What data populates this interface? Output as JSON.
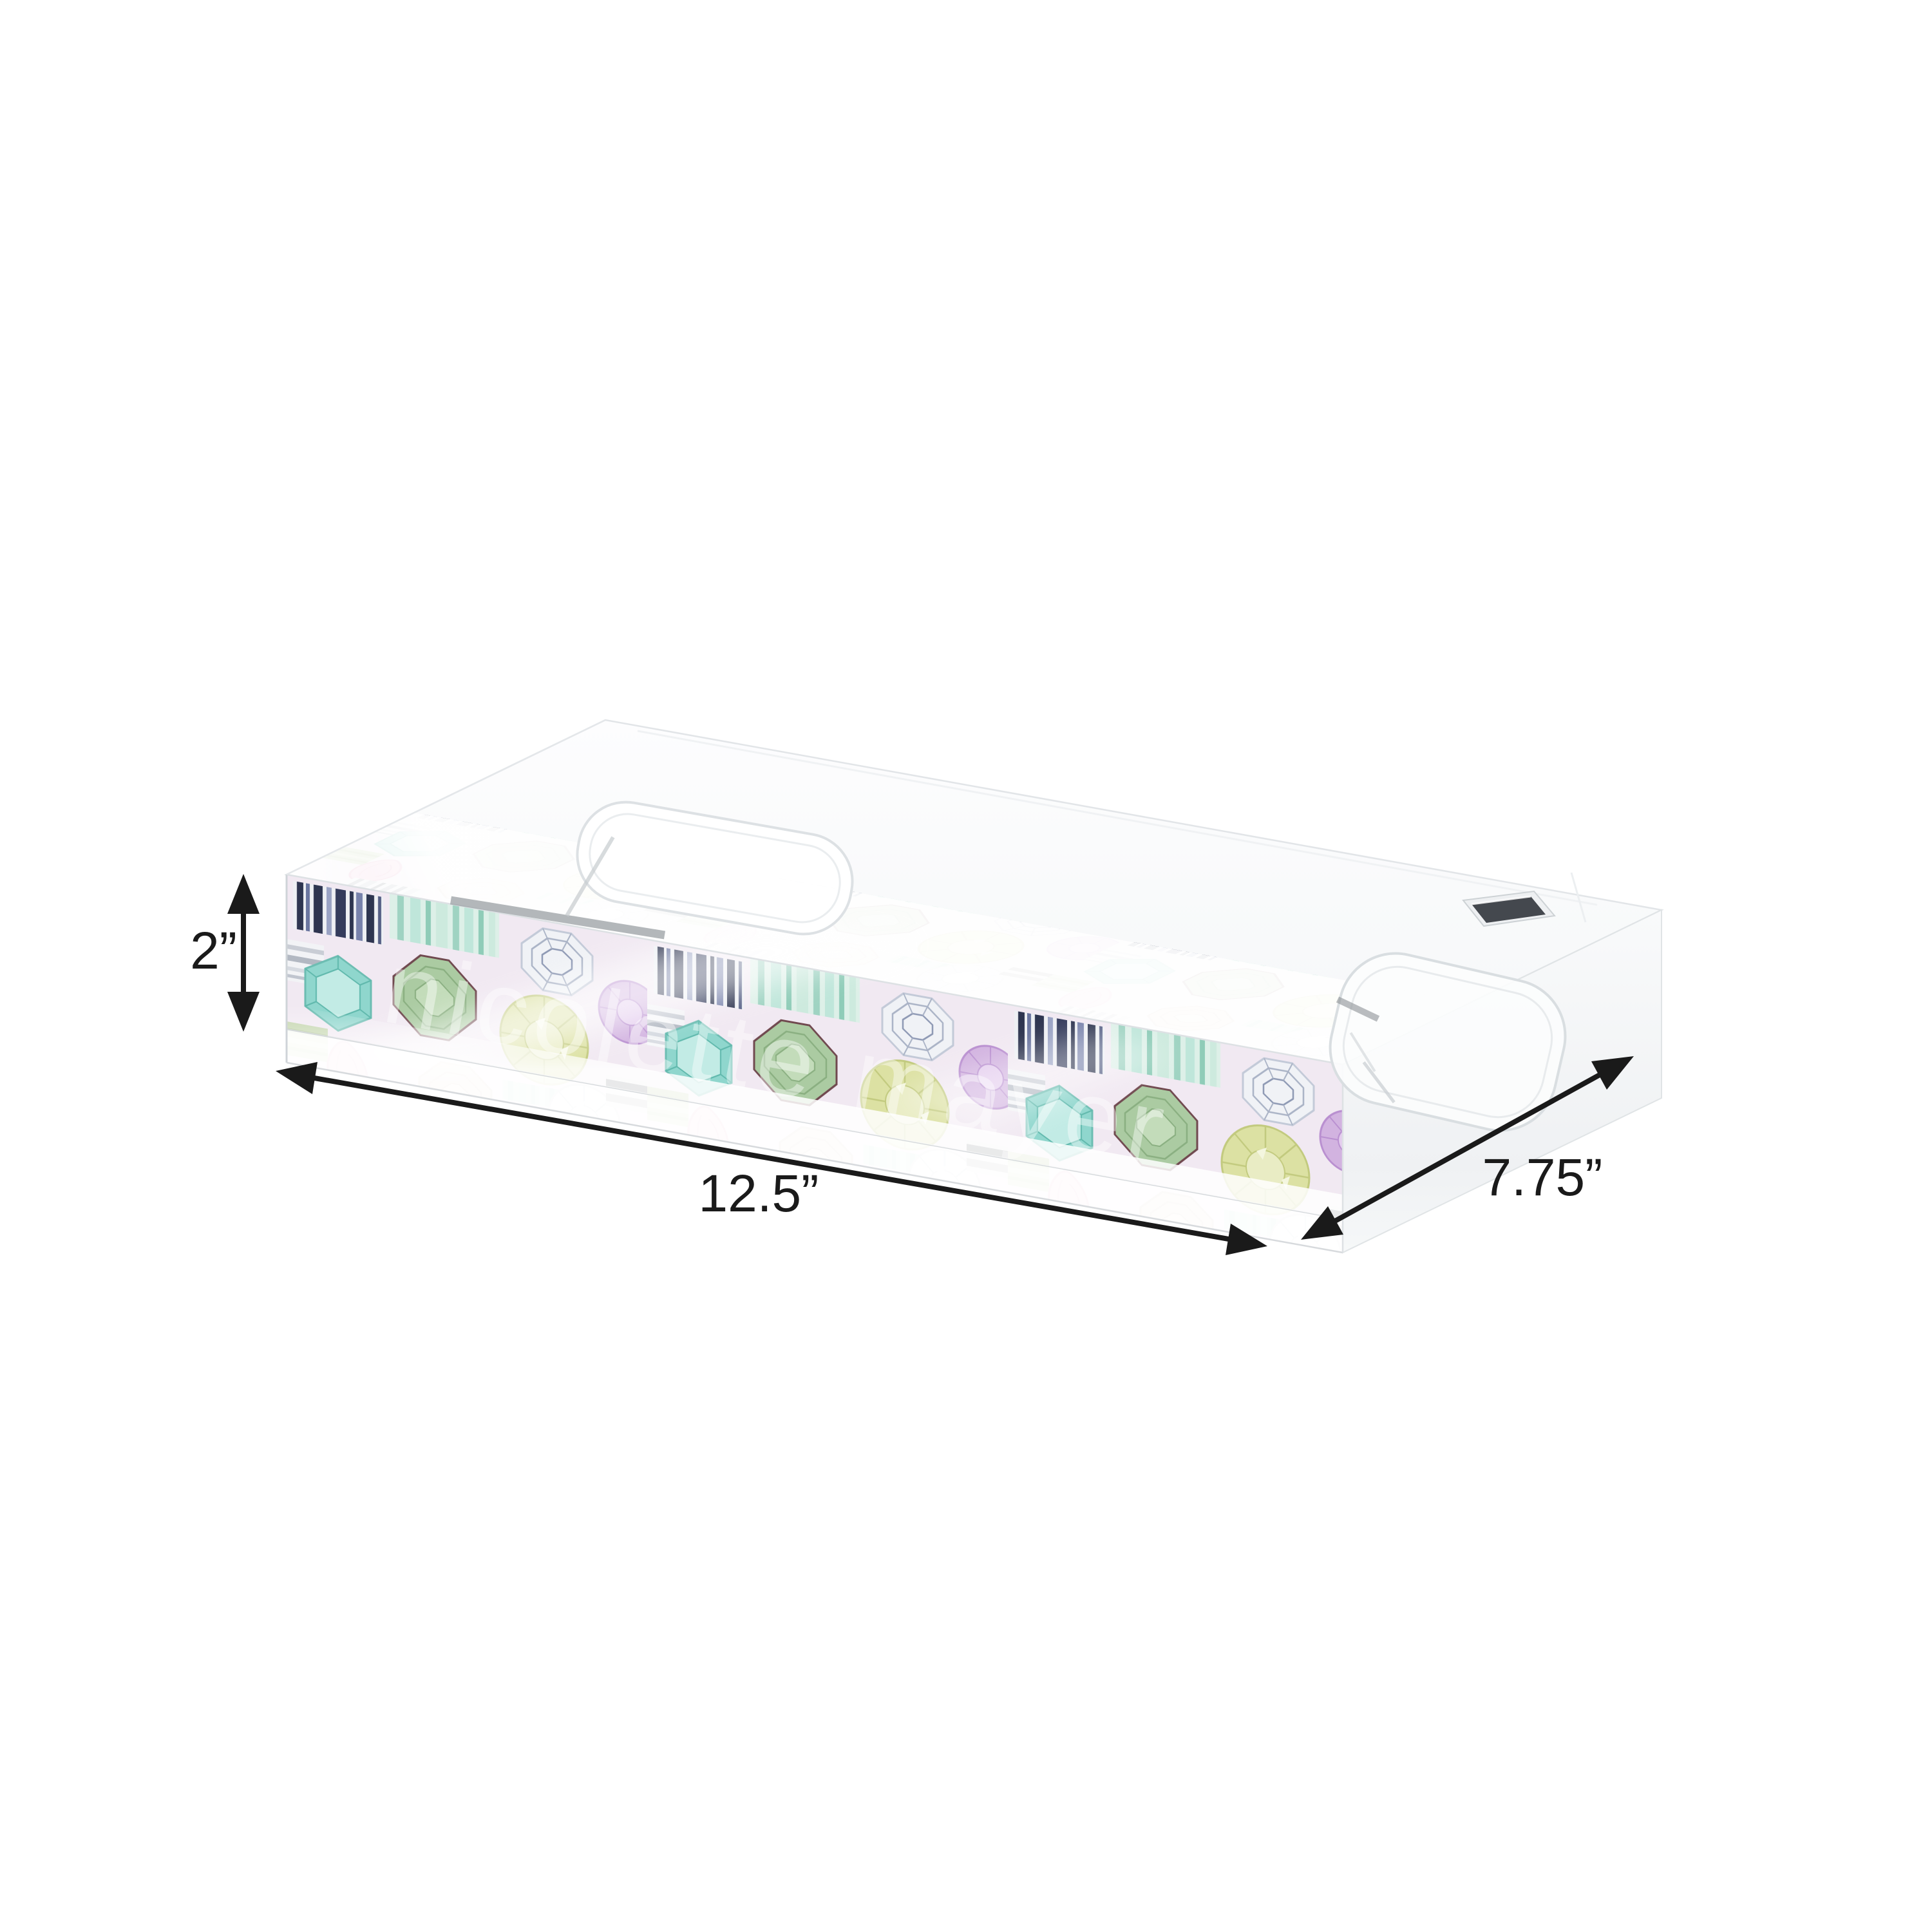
{
  "scene": {
    "background_color": "#ffffff",
    "annotation_color": "#1a1a1a"
  },
  "dimensions": {
    "height_label": "2”",
    "length_label": "12.5”",
    "depth_label": "7.75”"
  },
  "tray": {
    "watermark_text": "nicolette mayer",
    "acrylic_white": "#fbfcfd",
    "edge_gray": "#dfe3e6",
    "gem_palette": {
      "pattern_background": "#f1e9f2",
      "mint": "#bfe6da",
      "teal": "#8fd6cd",
      "sage_green": "#abcba2",
      "chartreuse": "#dce1a3",
      "lavender": "#d2b3e0",
      "pink": "#f3c2d8",
      "champagne": "#e6d6c7",
      "diamond_white": "#f3f4f7",
      "navy_stripe": "#2e3550",
      "gray_stripe": "#6a6f73"
    }
  }
}
